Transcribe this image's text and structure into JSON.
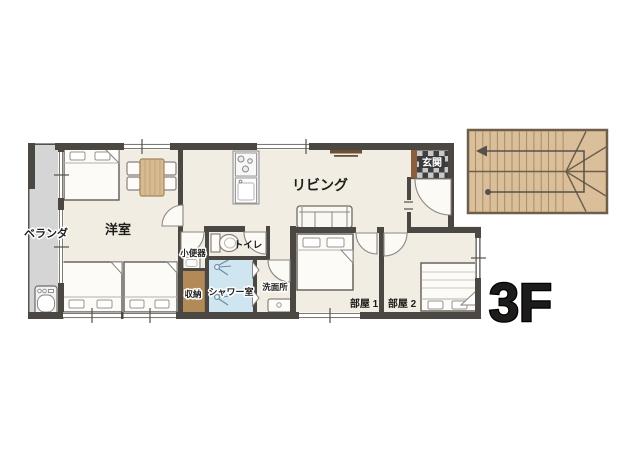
{
  "floor": {
    "label": "3F"
  },
  "rooms": {
    "veranda": "ベランダ",
    "western_room": "洋室",
    "living": "リビング",
    "entrance": "玄関",
    "urinal_room": "小便器",
    "toilet": "トイレ",
    "shower_room": "シャワー室",
    "washroom": "洗面所",
    "storage": "収納",
    "room1": "部屋 1",
    "room2": "部屋 2"
  },
  "colors": {
    "wall": "#4b4743",
    "floor": "#f2ede3",
    "veranda": "#d5d5d5",
    "shower_blue": "#cfe6f1",
    "storage_brown": "#b18a58",
    "stairs_tan": "#dabf9a",
    "table_wood": "#d7ba92",
    "tv_brown": "#6b5036",
    "entrance_tile_dark": "#3f3f3f",
    "entrance_tile_light": "#c8c8c8",
    "entrance_cabinet": "#8a5f3d"
  }
}
